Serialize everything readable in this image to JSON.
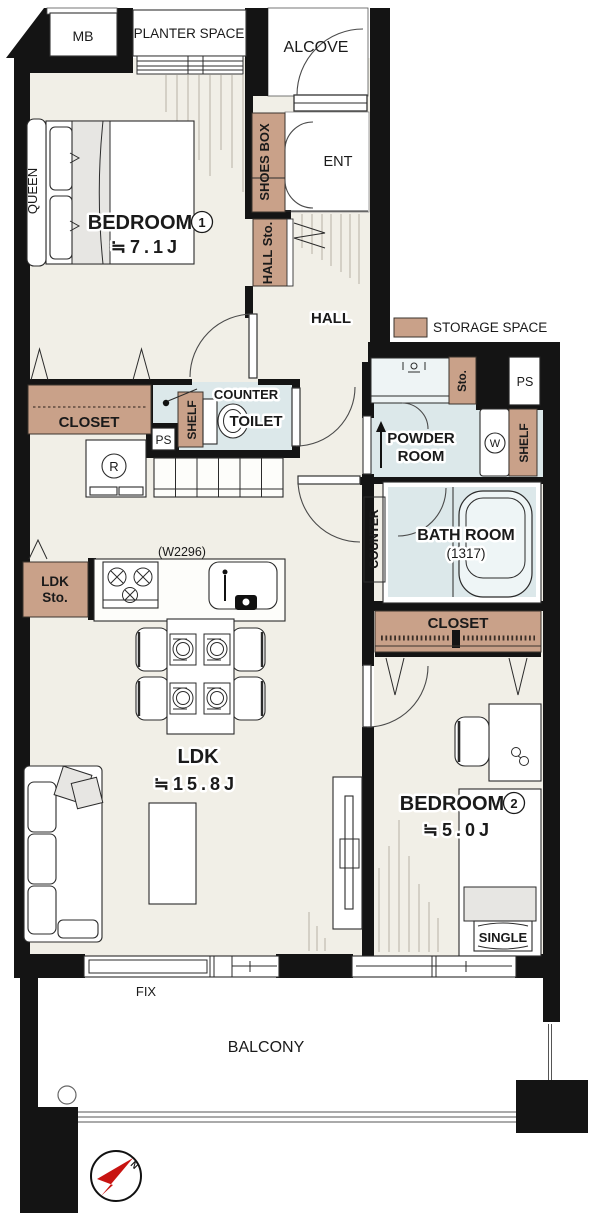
{
  "colors": {
    "wall": "#141414",
    "floor": "#f1efe7",
    "wet": "#dce8ea",
    "storage": "#c9a189",
    "hatch": "#b8b2a6",
    "north_red": "#c81411"
  },
  "legend": {
    "storage": "STORAGE SPACE"
  },
  "exterior": {
    "mb": "MB",
    "planter": "PLANTER SPACE",
    "alcove": "ALCOVE",
    "fix": "FIX",
    "balcony": "BALCONY",
    "north": "N"
  },
  "entrance": {
    "room": "ENT",
    "shoes_box": "SHOES BOX",
    "hall_storage": "HALL Sto.",
    "hall": "HALL"
  },
  "bedroom1": {
    "name": "BEDROOM",
    "number": "1",
    "size": "≒7.1J",
    "bed": "QUEEN",
    "closet": "CLOSET"
  },
  "toilet": {
    "name": "TOILET",
    "counter": "COUNTER",
    "shelf": "SHELF",
    "ps": "PS"
  },
  "kitchen": {
    "width_note": "(W2296)",
    "fridge": "R",
    "storage_line1": "LDK",
    "storage_line2": "Sto."
  },
  "powder": {
    "name_line1": "POWDER",
    "name_line2": "ROOM",
    "storage": "Sto.",
    "ps": "PS",
    "washer": "W",
    "shelf": "SHELF"
  },
  "bath": {
    "name": "BATH ROOM",
    "size": "(1317)",
    "counter": "COUNTER"
  },
  "ldk": {
    "name": "LDK",
    "size": "≒15.8J"
  },
  "bedroom2": {
    "name": "BEDROOM",
    "number": "2",
    "size": "≒5.0J",
    "bed": "SINGLE",
    "closet": "CLOSET"
  }
}
